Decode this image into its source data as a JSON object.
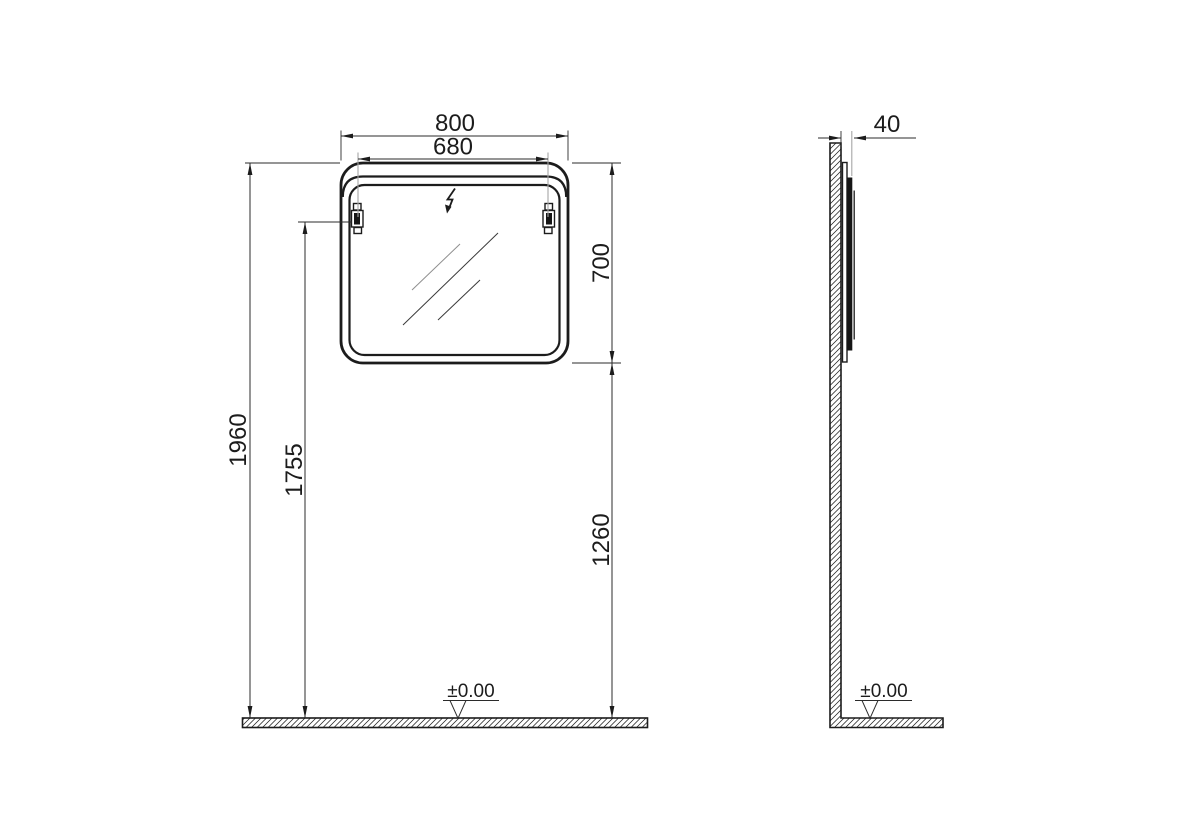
{
  "drawing": {
    "type": "technical-installation-drawing",
    "subject": "wall-mounted illuminated mirror, front and side views",
    "front_view": {
      "dim_width_outer": "800",
      "dim_width_mounting": "680",
      "dim_height_mirror": "700",
      "dim_height_top": "1960",
      "dim_height_brackets": "1755",
      "dim_height_bottom": "1260",
      "floor_level": "±0.00"
    },
    "side_view": {
      "dim_depth": "40",
      "floor_level": "±0.00"
    },
    "colors": {
      "line": "#1c1c1c",
      "dimension_line": "#2b2b2b",
      "extension_gray": "#a6a6a6",
      "background": "#ffffff"
    }
  }
}
